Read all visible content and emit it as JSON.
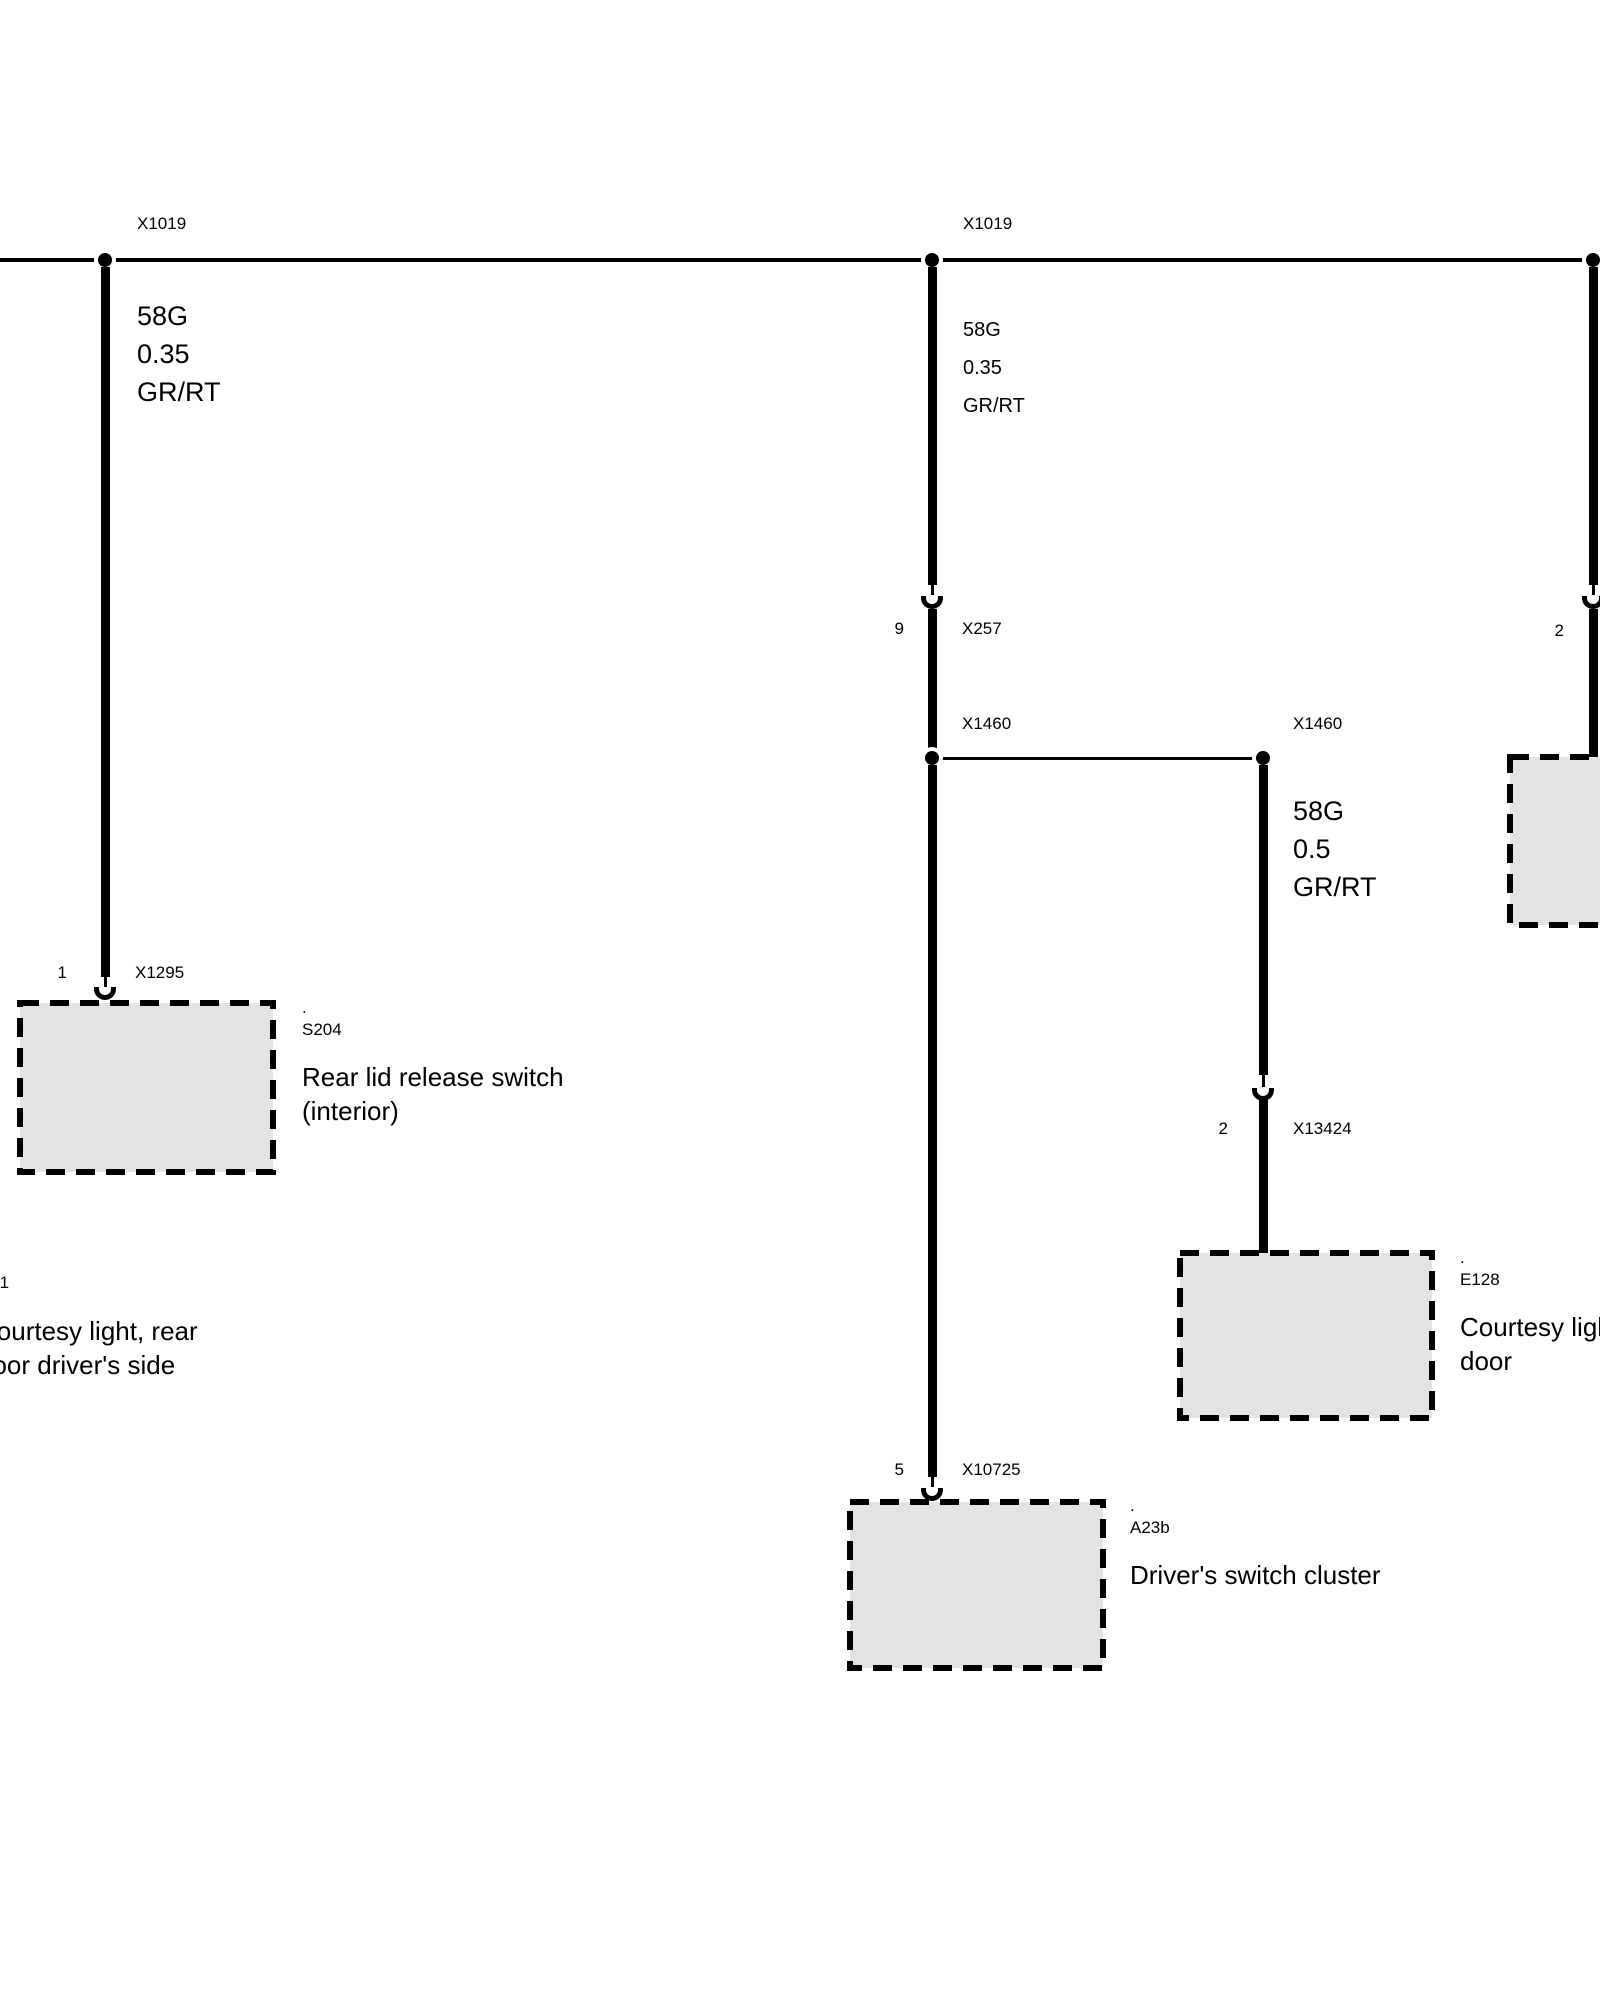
{
  "colors": {
    "background": "#ffffff",
    "line": "#000000",
    "component_box_fill": "#e3e3e3"
  },
  "connectors": {
    "x1019_left": {
      "id": "X1019"
    },
    "x1019_mid": {
      "id": "X1019"
    },
    "x257": {
      "pin": "9",
      "id": "X257"
    },
    "x1460_left": {
      "id": "X1460"
    },
    "x1460_right": {
      "id": "X1460"
    },
    "x1295": {
      "pin": "1",
      "id": "X1295"
    },
    "x10725": {
      "pin": "5",
      "id": "X10725"
    },
    "x13424": {
      "pin": "2",
      "id": "X13424"
    },
    "right_edge": {
      "pin": "2"
    }
  },
  "wires": {
    "left": {
      "circuit": "58G",
      "cross_section": "0.35",
      "color_code": "GR/RT"
    },
    "middle": {
      "circuit": "58G",
      "cross_section": "0.35",
      "color_code": "GR/RT"
    },
    "door": {
      "circuit": "58G",
      "cross_section": "0.5",
      "color_code": "GR/RT"
    }
  },
  "components": {
    "s204": {
      "dot": ".",
      "code": "S204",
      "name_line1": "Rear lid release switch",
      "name_line2": "(interior)"
    },
    "a23b": {
      "dot": ".",
      "code": "A23b",
      "name_line1": "Driver's switch cluster"
    },
    "e128": {
      "dot": ".",
      "code": "E128",
      "name_line1": "Courtesy light,",
      "name_line2": "door"
    },
    "left_offscreen": {
      "code_fragment": "-1",
      "name_line1": "Courtesy light, rear",
      "name_line2": "door driver's side"
    }
  }
}
